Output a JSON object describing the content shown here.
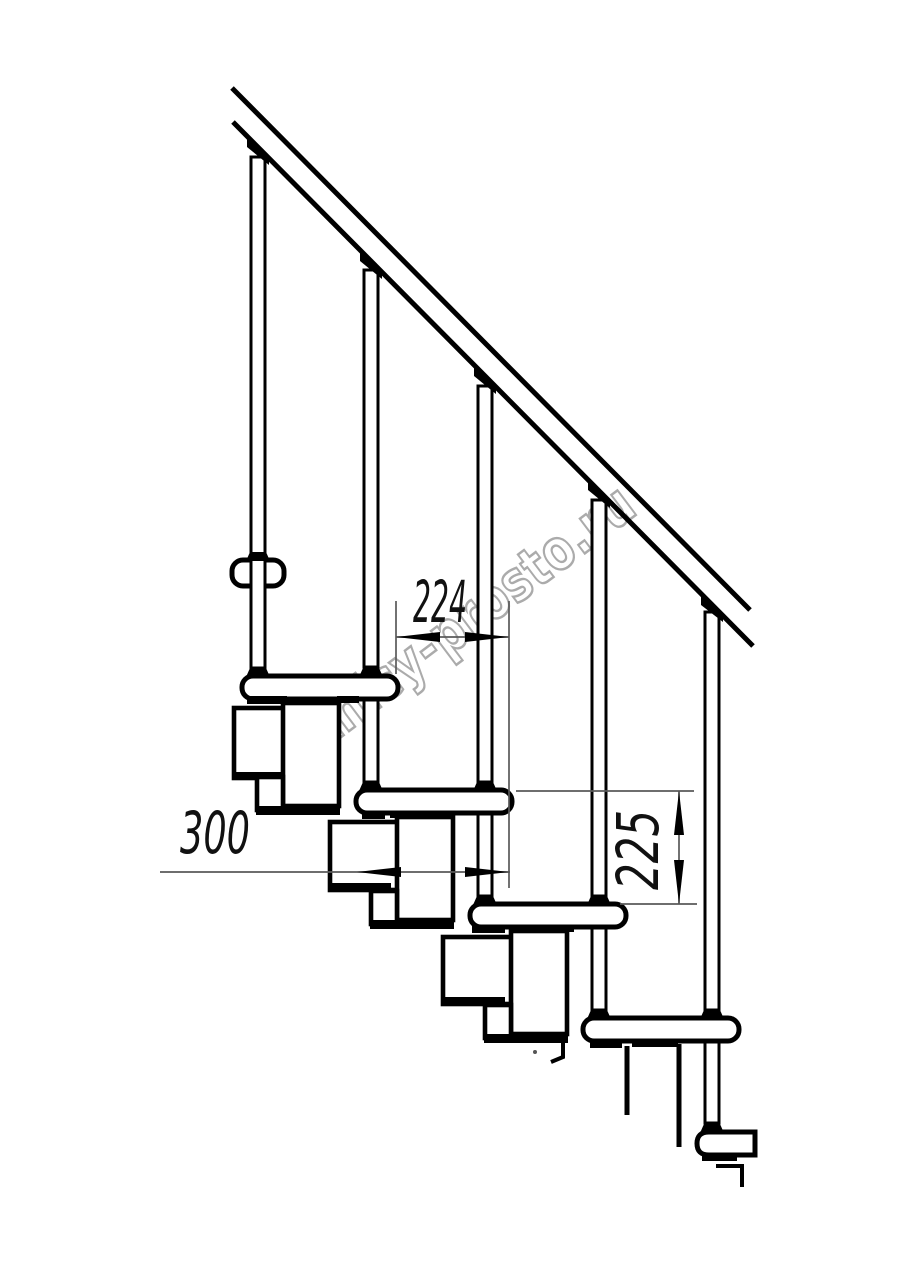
{
  "watermark": {
    "text": "lestnicy-prosto.ru"
  },
  "dimensions": {
    "step_spacing": "224",
    "tread_depth": "300",
    "riser_height": "225"
  },
  "colors": {
    "ink": "#000000",
    "dimension_lines": "#5a5a5a",
    "watermark_outline": "#ababab",
    "background": "#ffffff"
  },
  "structure": {
    "balusters": 5,
    "treads_visible": 6,
    "handrail_lines": 2
  }
}
